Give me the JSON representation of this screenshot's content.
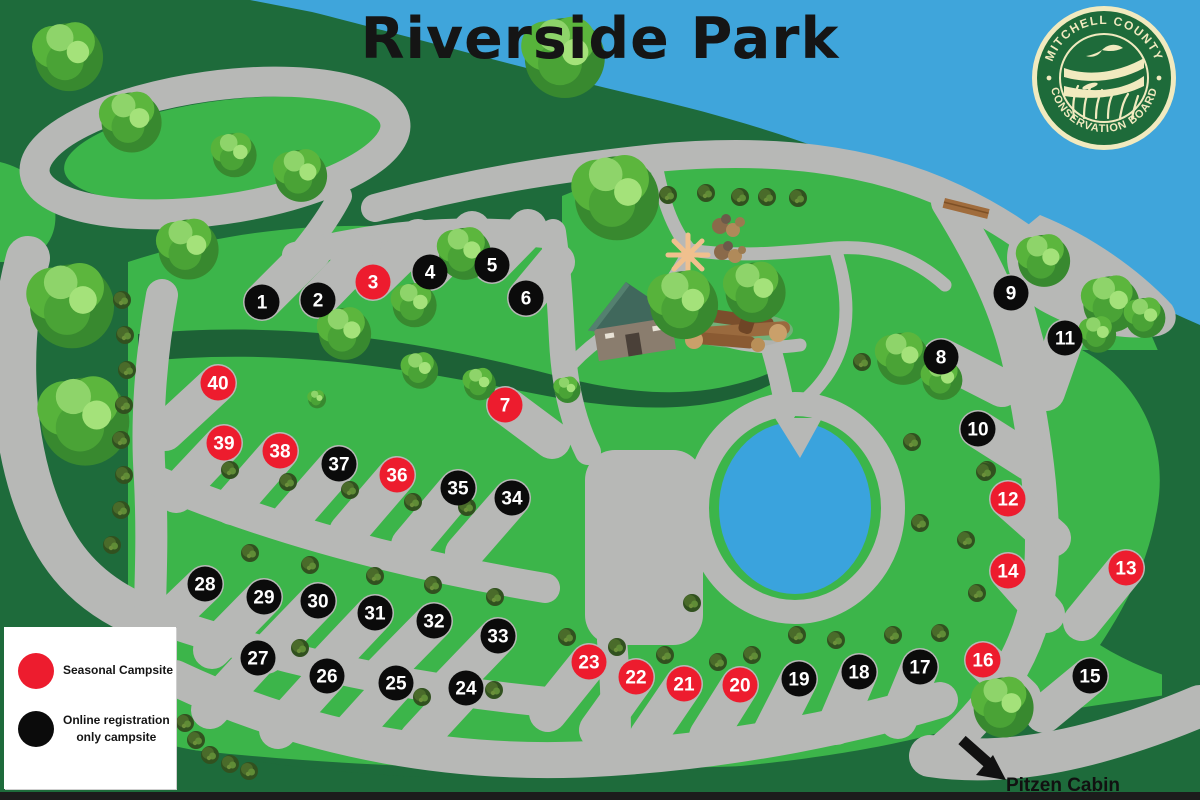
{
  "title": "Riverside Park",
  "logo": {
    "top_text": "MITCHELL COUNTY",
    "bottom_text": "CONSERVATION BOARD"
  },
  "legend": {
    "items": [
      {
        "swatch_color": "#ED1C2E",
        "lines": [
          "Seasonal Campsite",
          ""
        ]
      },
      {
        "swatch_color": "#0B0B0B",
        "lines": [
          "Online registration",
          "only campsite"
        ]
      }
    ]
  },
  "annotations": {
    "cabin_label": "Pitzen Cabin"
  },
  "colors": {
    "river": "#3fa5db",
    "pond": "#3aa3dd",
    "grass": "#3cb54a",
    "forest": "#1e6b3b",
    "road": "#b7b8b6",
    "seasonal": "#ED1C2E",
    "online": "#0b0b0b",
    "marker_text": "#ffffff"
  },
  "markers": [
    {
      "n": 1,
      "x": 262,
      "y": 302,
      "type": "online",
      "bx": 312,
      "by": 252
    },
    {
      "n": 2,
      "x": 318,
      "y": 300,
      "type": "online",
      "bx": 365,
      "by": 252
    },
    {
      "n": 3,
      "x": 373,
      "y": 282,
      "type": "seasonal",
      "bx": 418,
      "by": 238
    },
    {
      "n": 4,
      "x": 430,
      "y": 272,
      "type": "online",
      "bx": 472,
      "by": 230
    },
    {
      "n": 5,
      "x": 492,
      "y": 265,
      "type": "online",
      "bx": 528,
      "by": 228
    },
    {
      "n": 6,
      "x": 526,
      "y": 298,
      "type": "online",
      "bx": 556,
      "by": 262
    },
    {
      "n": 7,
      "x": 505,
      "y": 405,
      "type": "seasonal",
      "bx": 552,
      "by": 440
    },
    {
      "n": 8,
      "x": 941,
      "y": 357,
      "type": "online",
      "bx": 1002,
      "by": 388
    },
    {
      "n": 9,
      "x": 1011,
      "y": 293,
      "type": "online",
      "bx": 1026,
      "by": 348
    },
    {
      "n": 10,
      "x": 978,
      "y": 429,
      "type": "online",
      "bx": 1030,
      "by": 462
    },
    {
      "n": 11,
      "x": 1065,
      "y": 338,
      "type": "online",
      "bx": 1046,
      "by": 392
    },
    {
      "n": 12,
      "x": 1008,
      "y": 499,
      "type": "seasonal",
      "bx": 1052,
      "by": 538
    },
    {
      "n": 13,
      "x": 1126,
      "y": 568,
      "type": "seasonal",
      "bx": 1082,
      "by": 622
    },
    {
      "n": 14,
      "x": 1008,
      "y": 571,
      "type": "seasonal",
      "bx": 1046,
      "by": 614
    },
    {
      "n": 15,
      "x": 1090,
      "y": 676,
      "type": "online",
      "bx": 1044,
      "by": 714
    },
    {
      "n": 16,
      "x": 983,
      "y": 660,
      "type": "seasonal",
      "bx": 1022,
      "by": 697
    },
    {
      "n": 17,
      "x": 920,
      "y": 667,
      "type": "online",
      "bx": 898,
      "by": 720
    },
    {
      "n": 18,
      "x": 859,
      "y": 672,
      "type": "online",
      "bx": 836,
      "by": 726
    },
    {
      "n": 19,
      "x": 799,
      "y": 679,
      "type": "online",
      "bx": 772,
      "by": 732
    },
    {
      "n": 20,
      "x": 740,
      "y": 685,
      "type": "seasonal",
      "bx": 708,
      "by": 736
    },
    {
      "n": 21,
      "x": 684,
      "y": 684,
      "type": "seasonal",
      "bx": 648,
      "by": 737
    },
    {
      "n": 22,
      "x": 636,
      "y": 677,
      "type": "seasonal",
      "bx": 598,
      "by": 730
    },
    {
      "n": 23,
      "x": 589,
      "y": 662,
      "type": "seasonal",
      "bx": 548,
      "by": 713
    },
    {
      "n": 24,
      "x": 466,
      "y": 688,
      "type": "online",
      "bx": 418,
      "by": 740
    },
    {
      "n": 25,
      "x": 396,
      "y": 683,
      "type": "online",
      "bx": 348,
      "by": 736
    },
    {
      "n": 26,
      "x": 327,
      "y": 676,
      "type": "online",
      "bx": 278,
      "by": 730
    },
    {
      "n": 27,
      "x": 258,
      "y": 658,
      "type": "online",
      "bx": 210,
      "by": 710
    },
    {
      "n": 28,
      "x": 205,
      "y": 584,
      "type": "online",
      "bx": 155,
      "by": 632
    },
    {
      "n": 29,
      "x": 264,
      "y": 597,
      "type": "online",
      "bx": 212,
      "by": 650
    },
    {
      "n": 30,
      "x": 318,
      "y": 601,
      "type": "online",
      "bx": 266,
      "by": 655
    },
    {
      "n": 31,
      "x": 375,
      "y": 613,
      "type": "online",
      "bx": 324,
      "by": 667
    },
    {
      "n": 32,
      "x": 434,
      "y": 621,
      "type": "online",
      "bx": 382,
      "by": 674
    },
    {
      "n": 33,
      "x": 498,
      "y": 636,
      "type": "online",
      "bx": 446,
      "by": 690
    },
    {
      "n": 34,
      "x": 512,
      "y": 498,
      "type": "online",
      "bx": 464,
      "by": 553
    },
    {
      "n": 35,
      "x": 458,
      "y": 488,
      "type": "online",
      "bx": 410,
      "by": 545
    },
    {
      "n": 36,
      "x": 397,
      "y": 475,
      "type": "seasonal",
      "bx": 348,
      "by": 532
    },
    {
      "n": 37,
      "x": 339,
      "y": 464,
      "type": "online",
      "bx": 290,
      "by": 520
    },
    {
      "n": 38,
      "x": 280,
      "y": 451,
      "type": "seasonal",
      "bx": 232,
      "by": 506
    },
    {
      "n": 39,
      "x": 224,
      "y": 443,
      "type": "seasonal",
      "bx": 176,
      "by": 494
    },
    {
      "n": 40,
      "x": 218,
      "y": 383,
      "type": "seasonal",
      "bx": 165,
      "by": 432
    }
  ]
}
